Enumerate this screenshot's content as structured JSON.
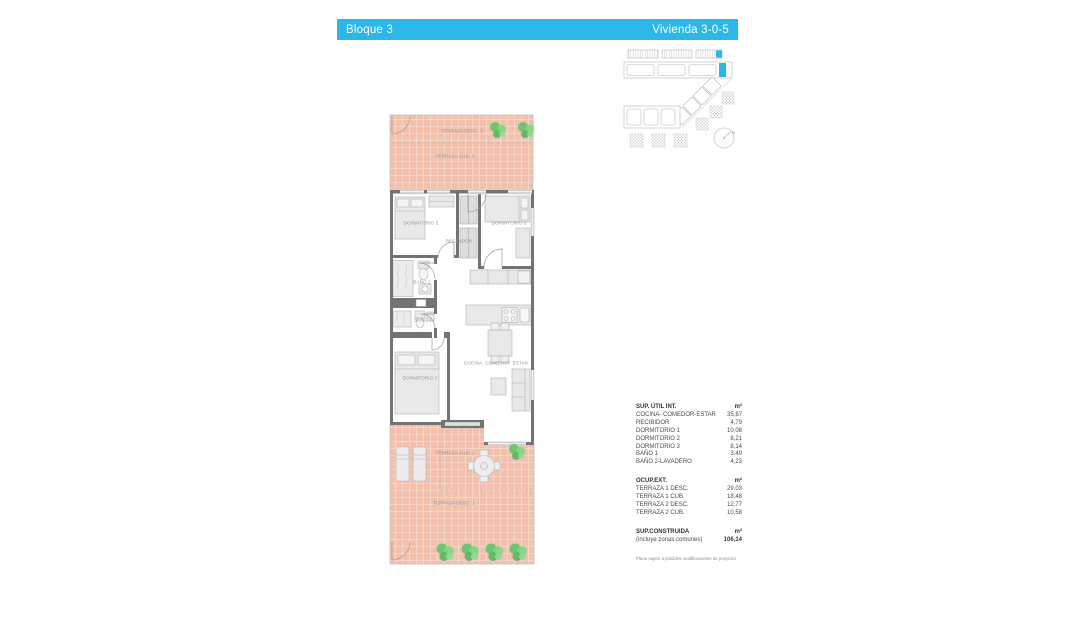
{
  "header": {
    "block_label": "Bloque 3",
    "unit_label": "Vivienda 3-0-5"
  },
  "key_plan": {
    "north_label": "N",
    "highlight_color": "#2bb8e8"
  },
  "floor_plan": {
    "labels": {
      "terraza_desc_2": "TERRAZA DESC. 2",
      "terraza_cub_2": "TERRAZA CUB. 2",
      "dormitorio_2": "DORMITORIO 2",
      "dormitorio_3": "DORMITORIO 3",
      "recibidor": "RECIBIDOR",
      "bano_2": "BAÑO 2",
      "bano_1": "BAÑO 1",
      "dormitorio_1": "DORMITORIO 1",
      "cocina": "COCINA. COMEDOR. ESTAR",
      "terraza_cub_1": "TERRAZA CUB. 1",
      "terraza_desc_1": "TERRAZA DESC. 1"
    }
  },
  "surface_tables": {
    "sup_util": {
      "title": "SUP. ÚTIL INT.",
      "unit": "m²",
      "rows": [
        {
          "label": "COCINA- COMEDOR-ESTAR",
          "value": "35,87"
        },
        {
          "label": "RECIBIDOR",
          "value": "4,79"
        },
        {
          "label": "DORMITORIO 1",
          "value": "10,08"
        },
        {
          "label": "DORMITORIO 2",
          "value": "8,21"
        },
        {
          "label": "DORMITORIO 3",
          "value": "8,14"
        },
        {
          "label": "BAÑO 1",
          "value": "3,49"
        },
        {
          "label": "BAÑO 2-LAVADERO",
          "value": "4,23"
        }
      ]
    },
    "ocup_ext": {
      "title": "OCUP.EXT.",
      "unit": "m²",
      "rows": [
        {
          "label": "TERRAZA 1 DESC.",
          "value": "29,03"
        },
        {
          "label": "TERRAZA 1 CUB.",
          "value": "18,48"
        },
        {
          "label": "TERRAZA 2 DESC.",
          "value": "12,77"
        },
        {
          "label": "TERRAZA 2 CUB.",
          "value": "10,58"
        }
      ]
    },
    "sup_construida": {
      "title": "SUP.CONSTRUIDA",
      "subtitle": "(incluye zonas comunes)",
      "unit": "m²",
      "value": "106,14"
    }
  },
  "footnote": "Plano sujeto a posibles modificaciones de proyecto",
  "colors": {
    "accent": "#2bb8e8",
    "terrace_fill": "#f3c0ac",
    "wall": "#737373",
    "plant_green": "#63c468"
  }
}
